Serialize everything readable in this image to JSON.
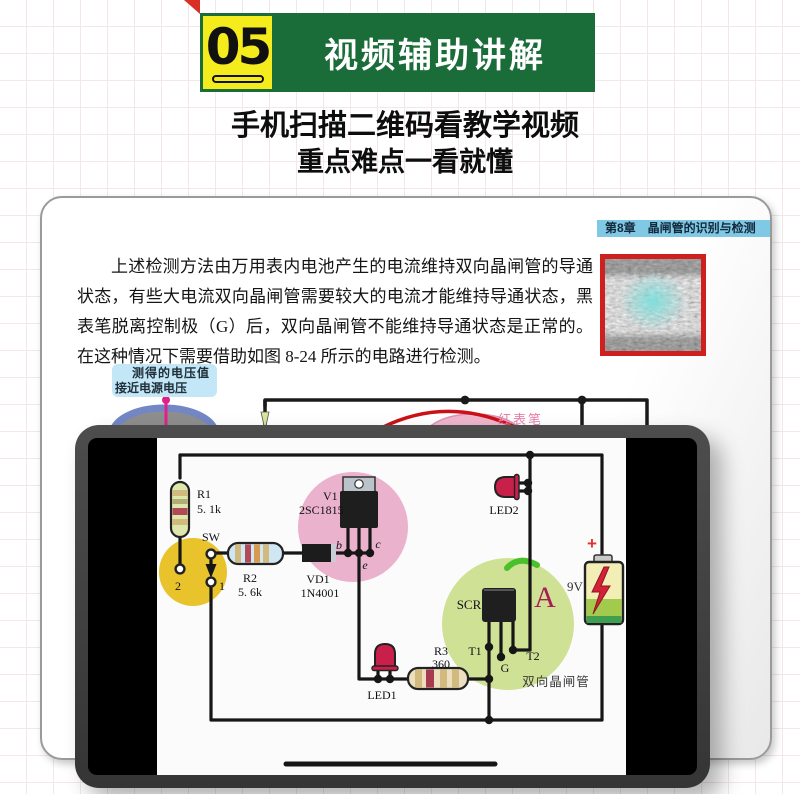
{
  "header": {
    "number": "05",
    "title": "视频辅助讲解",
    "tagline1": "手机扫描二维码看教学视频",
    "tagline2": "重点难点一看就懂"
  },
  "book": {
    "chapter": "第8章　晶闸管的识别与检测",
    "paragraph": "上述检测方法由万用表内电池产生的电流维持双向晶闸管的导通状态，有些大电流双向晶闸管需要较大的电流才能维持导通状态，黑表笔脱离控制极（G）后，双向晶闸管不能维持导通状态是正常的。在这种情况下需要借助如图 8-24 所示的电路进行检测。",
    "callout_line1": "测得的电压值",
    "callout_line2": "接近电源电压",
    "red_probe_label": "红表笔"
  },
  "circuit": {
    "r1_name": "R1",
    "r1_value": "5. 1k",
    "sw_label": "SW",
    "contact_2": "2",
    "contact_1": "1",
    "r2_name": "R2",
    "r2_value": "5. 6k",
    "vd1_name": "VD1",
    "vd1_value": "1N4001",
    "v1_name": "V1",
    "v1_value": "2SC1815",
    "pin_b": "b",
    "pin_e": "e",
    "pin_c": "c",
    "led1": "LED1",
    "led2": "LED2",
    "r3_name": "R3",
    "r3_value": "360",
    "scr": "SCR",
    "t1": "T1",
    "g": "G",
    "t2": "T2",
    "triac": "双向晶闸管",
    "battery_plus": "+",
    "battery_voltage": "9V",
    "ammeter": "A"
  },
  "colors": {
    "banner_green": "#1a6c39",
    "box_yellow": "#f5ec1e",
    "chapter_blue": "#7fc9e4",
    "qr_border": "#cf2020",
    "callout_blue": "#c3e7f7",
    "probe_pink": "#ea7fab",
    "highlight_pink": "#eab2cc",
    "highlight_yellow": "#e8c32c",
    "highlight_green": "#cfe195",
    "led_red": "#c8204a"
  }
}
